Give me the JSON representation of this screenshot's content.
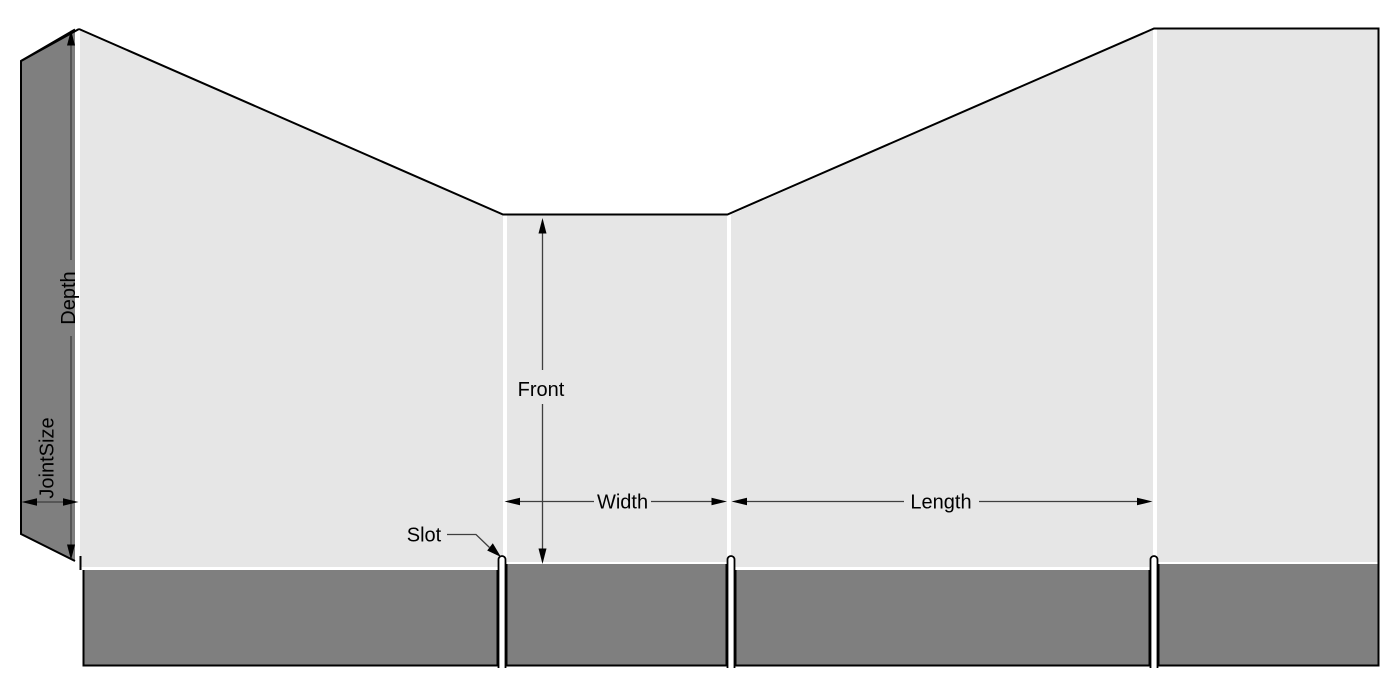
{
  "dieline": {
    "labels": {
      "depth": "Depth",
      "joint_size": "JointSize",
      "front": "Front",
      "width": "Width",
      "length": "Length",
      "slot": "Slot"
    },
    "colors": {
      "panel_fill": "#e6e6e6",
      "flap_fill": "#7f7f7f",
      "cut_line": "#000000",
      "dimension_line": "#3f3f3f",
      "label_text": "#000000",
      "background": "#ffffff"
    }
  }
}
